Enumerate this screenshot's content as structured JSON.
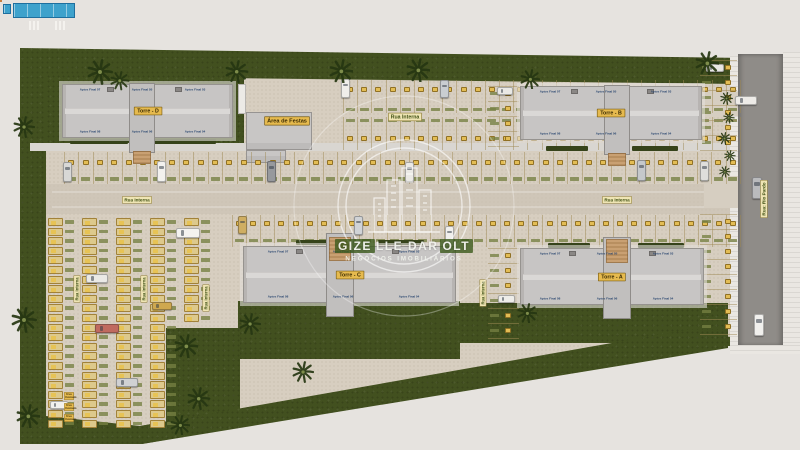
{
  "watermark": {
    "brand": "GIZELLE DAROLT",
    "brand_seg1": "GIZE",
    "brand_seg2": "LLE DAR",
    "brand_seg3": "OLT",
    "tagline": "NEGÓCIOS IMOBILIÁRIOS",
    "logo_icon": "skyline-buildings-in-circle"
  },
  "streets": {
    "internal": "Rua Interna",
    "external": "Rua: Rio Pardo"
  },
  "amenities": {
    "party_area": "Área de Festas",
    "common_use": "Uso Comum"
  },
  "towers": [
    {
      "id": "D",
      "name": "Torre - D",
      "apts_top": [
        "Aptos Final 07",
        "Aptos Final 05",
        "Aptos Final 03"
      ],
      "apts_bottom": [
        "Aptos Final 08",
        "Aptos Final 06",
        "Aptos Final 04"
      ]
    },
    {
      "id": "B",
      "name": "Torre - B",
      "apts_top": [
        "Aptos Final 07",
        "Aptos Final 05",
        "Aptos Final 03"
      ],
      "apts_bottom": [
        "Aptos Final 08",
        "Aptos Final 06",
        "Aptos Final 04"
      ]
    },
    {
      "id": "C",
      "name": "Torre - C",
      "apts_top": [
        "Aptos Final 07",
        "Aptos Final 05",
        "Aptos Final 03"
      ],
      "apts_bottom": [
        "Aptos Final 08",
        "Aptos Final 06",
        "Aptos Final 04"
      ]
    },
    {
      "id": "A",
      "name": "Torre - A",
      "apts_top": [
        "Aptos Final 07",
        "Aptos Final 05",
        "Aptos Final 03"
      ],
      "apts_bottom": [
        "Aptos Final 08",
        "Aptos Final 06",
        "Aptos Final 04"
      ]
    }
  ],
  "parking": {
    "sections": [
      "A",
      "B",
      "C",
      "D"
    ],
    "stall_tag_style": "yellow-number-plate",
    "stall_id_style": "green-code-label"
  },
  "colors": {
    "grass": "#42501f",
    "pavement": "#d7cec0",
    "building": "#c7c5c4",
    "accent_gold": "#e6ba4e",
    "badge_bg": "#efe5b4",
    "label_green": "#3f5014",
    "pool_water": "#3ea2cc",
    "deck_orange": "#ea9f5d",
    "asphalt": "#8f8c88",
    "apartment_label_blue": "#27446e"
  },
  "scene": {
    "badges": [
      {
        "t": "Rua Interna",
        "x": 405,
        "y": 117,
        "f": 5.2
      },
      {
        "t": "Rua Interna",
        "x": 137,
        "y": 200,
        "f": 4.6
      },
      {
        "t": "Rua Interna",
        "x": 617,
        "y": 200,
        "f": 4.6
      },
      {
        "t": "Rua Interna",
        "x": 77,
        "y": 289,
        "f": 4.2,
        "v": 1
      },
      {
        "t": "Rua Interna",
        "x": 144,
        "y": 289,
        "f": 4.2,
        "v": 1
      },
      {
        "t": "Rua Interna",
        "x": 206,
        "y": 298,
        "f": 4.2,
        "v": 1
      },
      {
        "t": "Rua Interna",
        "x": 483,
        "y": 293,
        "f": 4.2,
        "v": 1
      },
      {
        "t": "Rua: Rio Pardo",
        "x": 764,
        "y": 199,
        "f": 4.6,
        "v": 1,
        "n": "main-road-badge"
      },
      {
        "t": "Uso Comum",
        "x": 69,
        "y": 396,
        "f": 3,
        "g": 1,
        "w": 26,
        "n": "common-use-badge"
      },
      {
        "t": "Uso Comum",
        "x": 69,
        "y": 407,
        "f": 3,
        "g": 1,
        "w": 26,
        "n": "common-use-badge"
      },
      {
        "t": "Uso Comum",
        "x": 69,
        "y": 418,
        "f": 3,
        "g": 1,
        "w": 26,
        "n": "common-use-badge"
      },
      {
        "t": "Área de Festas",
        "x": 287,
        "y": 121,
        "f": 5.6,
        "g": 1,
        "n": "party-area-badge"
      }
    ],
    "hedges": [
      [
        70,
        139,
        58,
        5
      ],
      [
        152,
        139,
        64,
        5
      ],
      [
        546,
        88,
        42,
        5
      ],
      [
        632,
        88,
        46,
        5
      ],
      [
        546,
        146,
        42,
        5
      ],
      [
        632,
        146,
        46,
        5
      ],
      [
        522,
        115,
        15,
        13
      ],
      [
        296,
        240,
        42,
        5
      ],
      [
        378,
        240,
        46,
        5
      ],
      [
        246,
        267,
        15,
        13
      ],
      [
        548,
        243,
        42,
        5
      ],
      [
        638,
        243,
        46,
        5
      ],
      [
        522,
        277,
        15,
        13
      ]
    ],
    "zones": [
      {
        "k": "row",
        "x": 343,
        "y": 80,
        "w": 397,
        "h": 33,
        "n": 28,
        "tr": 0.28,
        "lr": 0.9
      },
      {
        "k": "row",
        "x": 343,
        "y": 117,
        "w": 397,
        "h": 33,
        "n": 28,
        "tr": 0.66,
        "lr": 0.1
      },
      {
        "k": "row",
        "x": 64,
        "y": 152,
        "w": 676,
        "h": 32,
        "n": 47,
        "tr": 0.34,
        "lr": 0.84
      },
      {
        "k": "row",
        "x": 232,
        "y": 215,
        "w": 508,
        "h": 32,
        "n": 36,
        "tr": 0.28,
        "lr": 0.8
      },
      {
        "k": "lot",
        "x": 46,
        "y": 218,
        "p": 9.6,
        "cols": [
          {
            "dx": 2,
            "rows": 22
          },
          {
            "dx": 36,
            "rows": 22
          },
          {
            "dx": 70,
            "rows": 22
          },
          {
            "dx": 104,
            "rows": 22
          },
          {
            "dx": 138,
            "rows": 11
          }
        ]
      },
      {
        "k": "col",
        "x": 700,
        "y": 60,
        "w": 37,
        "rows": 6,
        "p": 15,
        "tx": 25,
        "lx": 2
      },
      {
        "k": "col",
        "x": 700,
        "y": 214,
        "w": 37,
        "rows": 8,
        "p": 15,
        "tx": 25,
        "lx": 2
      },
      {
        "k": "col",
        "x": 488,
        "y": 86,
        "w": 31,
        "rows": 4,
        "p": 15,
        "tx": 17,
        "lx": 2
      },
      {
        "k": "col",
        "x": 488,
        "y": 248,
        "w": 31,
        "rows": 6,
        "p": 15,
        "tx": 17,
        "lx": 2
      }
    ],
    "cars": [
      [
        341,
        79,
        9,
        19,
        "#efeeea"
      ],
      [
        440,
        80,
        9,
        18,
        "#c9cdd1"
      ],
      [
        497,
        87,
        16,
        8,
        "#e9e8e4"
      ],
      [
        706,
        64,
        18,
        8,
        "#e8e7e3"
      ],
      [
        63,
        162,
        9,
        20,
        "#d8d8d6"
      ],
      [
        157,
        161,
        9,
        21,
        "#f2f1ee"
      ],
      [
        267,
        161,
        9,
        21,
        "#97999d"
      ],
      [
        405,
        162,
        9,
        20,
        "#ebe9e5"
      ],
      [
        637,
        160,
        9,
        21,
        "#c5c8cb"
      ],
      [
        700,
        161,
        9,
        20,
        "#dfdedb"
      ],
      [
        238,
        216,
        9,
        18,
        "#cfae62"
      ],
      [
        354,
        216,
        9,
        19,
        "#d0d3d6"
      ],
      [
        445,
        226,
        9,
        19,
        "#f0efec"
      ],
      [
        86,
        274,
        22,
        9,
        "#eae9e5"
      ],
      [
        176,
        228,
        24,
        10,
        "#f4f3f0"
      ],
      [
        95,
        324,
        24,
        9,
        "#c06a5f"
      ],
      [
        116,
        378,
        22,
        9,
        "#d0d1d3"
      ],
      [
        50,
        401,
        18,
        8,
        "#f2f1ee"
      ],
      [
        152,
        302,
        20,
        8,
        "#cfa84f"
      ],
      [
        735,
        96,
        22,
        9,
        "#edebe7"
      ],
      [
        752,
        177,
        10,
        22,
        "#babbbd"
      ],
      [
        754,
        314,
        10,
        22,
        "#f1f0ed"
      ],
      [
        498,
        295,
        17,
        8,
        "#eeede9"
      ]
    ],
    "palms": [
      [
        100,
        72,
        1
      ],
      [
        120,
        81,
        0.75
      ],
      [
        237,
        72,
        0.9
      ],
      [
        341,
        71,
        0.95
      ],
      [
        418,
        70,
        0.95
      ],
      [
        530,
        79,
        0.8
      ],
      [
        707,
        63,
        0.95
      ],
      [
        24,
        127,
        0.85
      ],
      [
        24,
        320,
        1
      ],
      [
        28,
        416,
        0.95
      ],
      [
        186,
        346,
        0.95
      ],
      [
        199,
        399,
        0.9
      ],
      [
        180,
        425,
        0.8
      ],
      [
        250,
        324,
        0.85
      ],
      [
        303,
        372,
        0.85
      ],
      [
        527,
        313,
        0.8
      ],
      [
        726,
        98,
        0.5
      ],
      [
        729,
        118,
        0.45
      ],
      [
        724,
        138,
        0.5
      ],
      [
        730,
        156,
        0.45
      ],
      [
        725,
        172,
        0.45
      ]
    ]
  }
}
